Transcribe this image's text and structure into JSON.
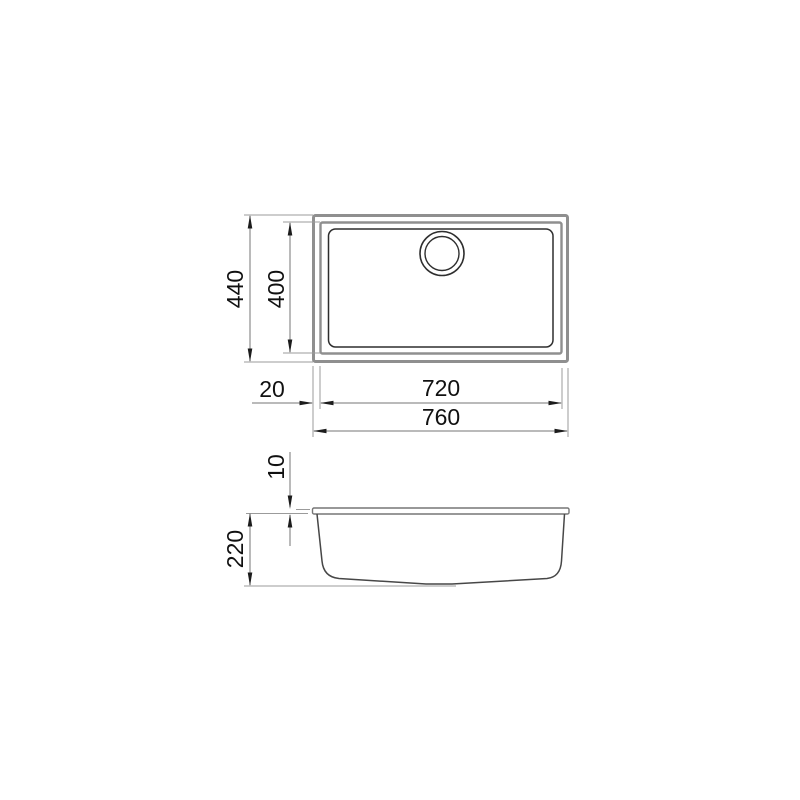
{
  "drawing": {
    "background": "#ffffff",
    "colors": {
      "outline_gray": "#8f8f8f",
      "outline_dark": "#2e2e2e",
      "rim_gray": "#767676",
      "bowl_dark": "#474747",
      "dim_line": "#757575",
      "ext_line": "#9b9b9b",
      "arrow": "#1c1c1c",
      "text": "#111111"
    },
    "top_view": {
      "dims": {
        "outer_height": "440",
        "bowl_height": "400",
        "edge_offset": "20",
        "bowl_width": "720",
        "outer_width": "760"
      }
    },
    "side_view": {
      "dims": {
        "rim_thickness": "10",
        "depth": "220"
      }
    }
  }
}
